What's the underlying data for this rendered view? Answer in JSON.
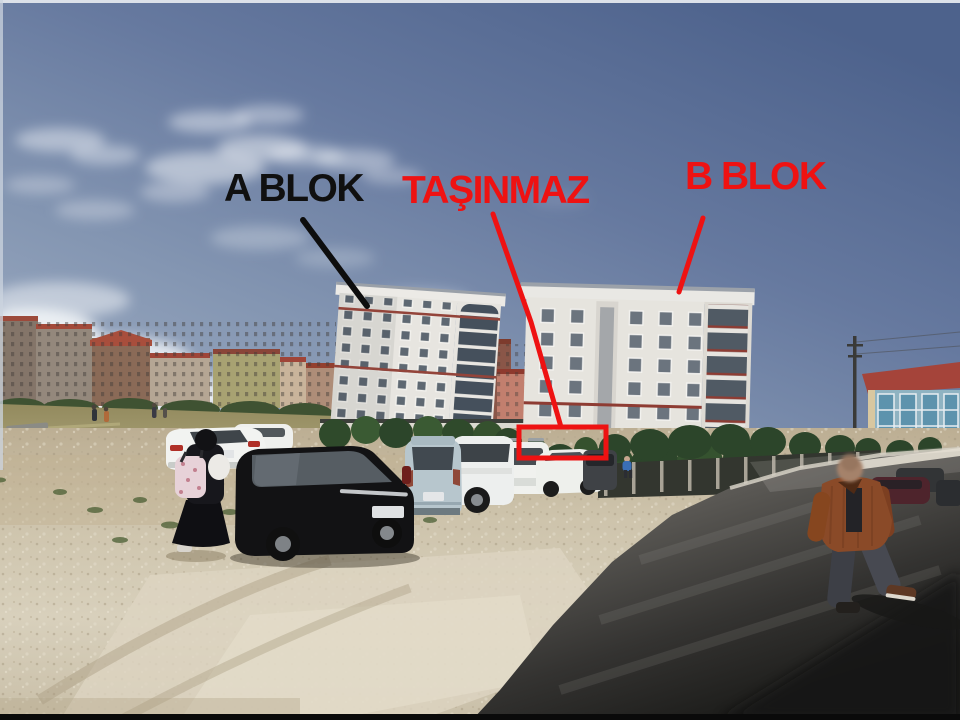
{
  "photo": {
    "annotations": {
      "a_blok": {
        "label": "A BLOK",
        "color": "#101010"
      },
      "tasinmaz": {
        "label": "TAŞINMAZ",
        "color": "#ee1212"
      },
      "b_blok": {
        "label": "B BLOK",
        "color": "#ee1212"
      },
      "highlight_box_color": "#ee1212"
    },
    "scene_colors": {
      "sky_top": "#4d628c",
      "sky_horizon": "#a7b4c8",
      "building_facade": "#e7e5e0",
      "trim_red": "#8e3c33",
      "gravel": "#cdc3ab",
      "asphalt": "#2b2b29"
    }
  }
}
